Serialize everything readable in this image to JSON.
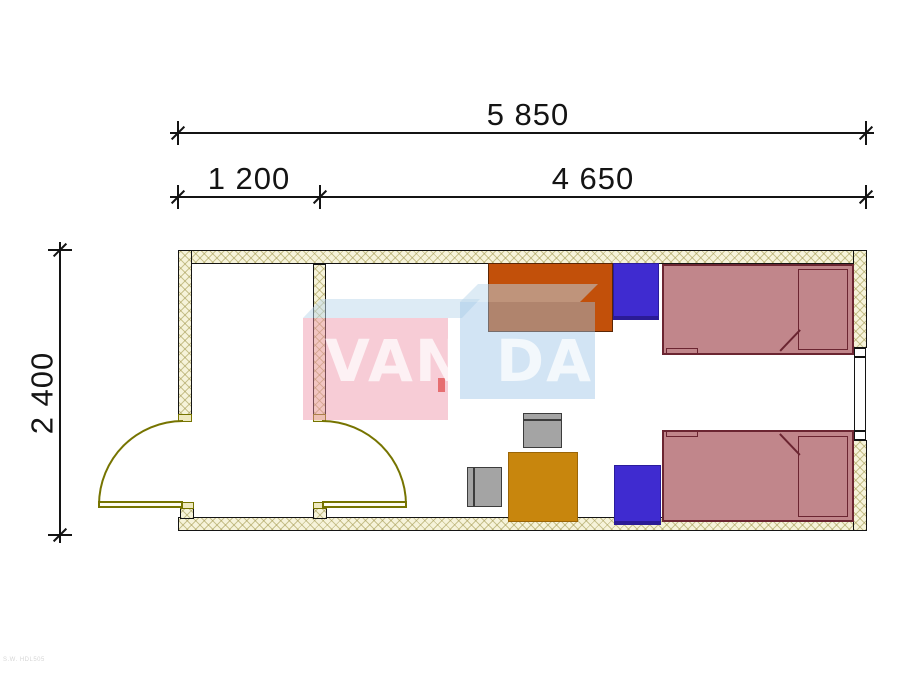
{
  "dimensions": {
    "total_width_mm": "5 850",
    "entry_width_mm": "1 200",
    "main_room_width_mm": "4 650",
    "depth_mm": "2 400"
  },
  "watermark": {
    "full": "VANDA",
    "left": "VAN",
    "right": "DA"
  },
  "footer_mark": "S.W. HDL505",
  "palette": {
    "line": "#141414",
    "wall_fill": "#f6f3da",
    "wall_hatch": "#a39950",
    "door_olive": "#767400",
    "bed_fill": "#c1868b",
    "bed_line": "#6b2531",
    "cabinet_blue": "#3f2bd0",
    "desk_orange": "#c2500a",
    "table_gold": "#c8860d",
    "chair_gray": "#a4a4a4",
    "watermark_pink": "#ee8fa4",
    "watermark_blue": "#9cc4e6"
  }
}
